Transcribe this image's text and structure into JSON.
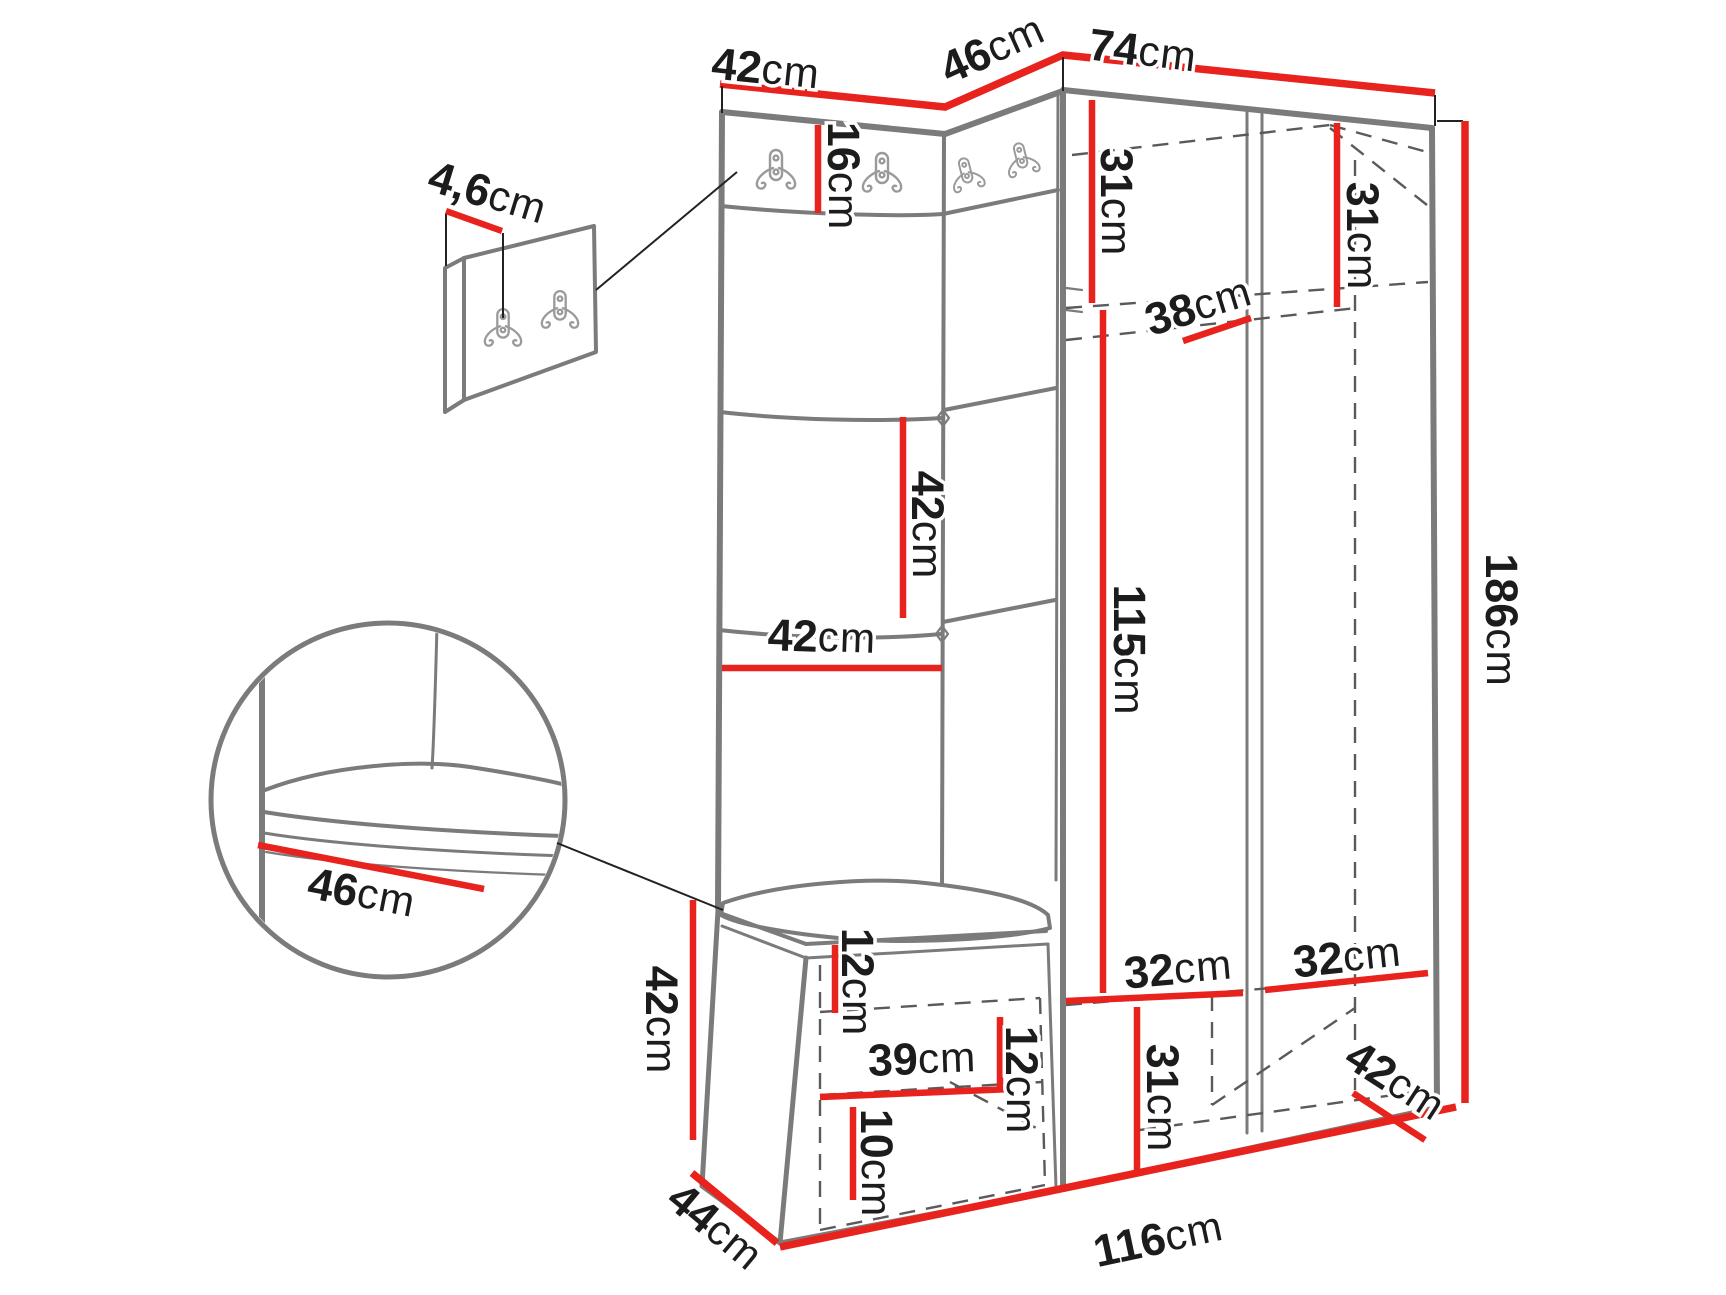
{
  "diagram": {
    "type": "furniture-dimension-drawing",
    "subject": "hallway wardrobe set with coat-hook panels, padded back tiles, shoe bench and tall cabinet"
  },
  "colors": {
    "dimension_red": "#e8221c",
    "outline_gray": "#7b7b7b",
    "dashed_gray": "#5a5a5a",
    "text_black": "#1c1c1c",
    "hook_gray": "#9a9a9a",
    "background": "#ffffff"
  },
  "icons": {
    "coat_hook": "double-coat-hook-icon",
    "main_unit_hook_count": 4,
    "detail_panel_hook_count": 2
  },
  "labels": [
    {
      "name": "top-left-width",
      "text": "42cm"
    },
    {
      "name": "corner-width",
      "text": "46cm"
    },
    {
      "name": "right-section-width",
      "text": "74cm"
    },
    {
      "name": "hook-panel-thickness",
      "text": "4,6cm"
    },
    {
      "name": "hook-strip-height",
      "text": "16cm"
    },
    {
      "name": "left-shelf-depth",
      "text": "31cm"
    },
    {
      "name": "right-shelf-depth",
      "text": "31cm"
    },
    {
      "name": "top-shelf-width",
      "text": "38cm"
    },
    {
      "name": "panel-tile-height",
      "text": "42cm"
    },
    {
      "name": "panel-tile-width",
      "text": "42cm"
    },
    {
      "name": "open-section-height",
      "text": "115cm"
    },
    {
      "name": "total-height",
      "text": "186cm"
    },
    {
      "name": "bench-seat-depth-detail",
      "text": "46cm"
    },
    {
      "name": "bench-height",
      "text": "42cm"
    },
    {
      "name": "bench-top-offset",
      "text": "12cm"
    },
    {
      "name": "bench-inner-width",
      "text": "39cm"
    },
    {
      "name": "bench-shelf-offset",
      "text": "12cm"
    },
    {
      "name": "bench-bottom-offset",
      "text": "10cm"
    },
    {
      "name": "bottom-compartment-height",
      "text": "31cm"
    },
    {
      "name": "bottom-shelf-depth-left",
      "text": "32cm"
    },
    {
      "name": "bottom-shelf-depth-right",
      "text": "32cm"
    },
    {
      "name": "bottom-right-depth",
      "text": "42cm"
    },
    {
      "name": "bench-depth",
      "text": "44cm"
    },
    {
      "name": "total-width",
      "text": "116cm"
    }
  ]
}
